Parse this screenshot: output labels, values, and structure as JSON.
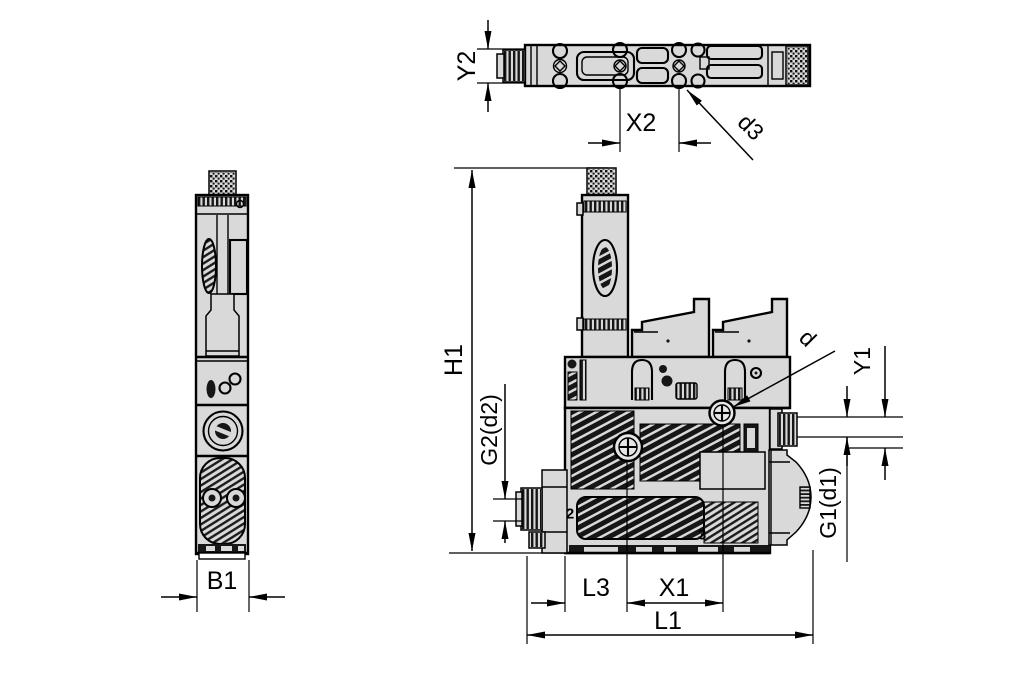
{
  "drawing_type": "technical dimension drawing, pneumatic vacuum generator, three orthographic views",
  "colors": {
    "background": "#ffffff",
    "lines": "#000000",
    "body_fill": "#d9d9d9",
    "hatch_fill": "#161616"
  },
  "views": {
    "top": {
      "dimensions": {
        "y2": "Y2",
        "x2": "X2",
        "d3": "d3"
      }
    },
    "side": {
      "dimensions": {
        "b1": "B1"
      }
    },
    "front": {
      "dimensions": {
        "h1": "H1",
        "g2_d2": "G2(d2)",
        "l3": "L3",
        "x1": "X1",
        "l1": "L1",
        "g1_d1": "G1(d1)",
        "y1": "Y1",
        "d": "d"
      },
      "port_markings": {
        "port2": "2",
        "port3": "3"
      }
    }
  }
}
